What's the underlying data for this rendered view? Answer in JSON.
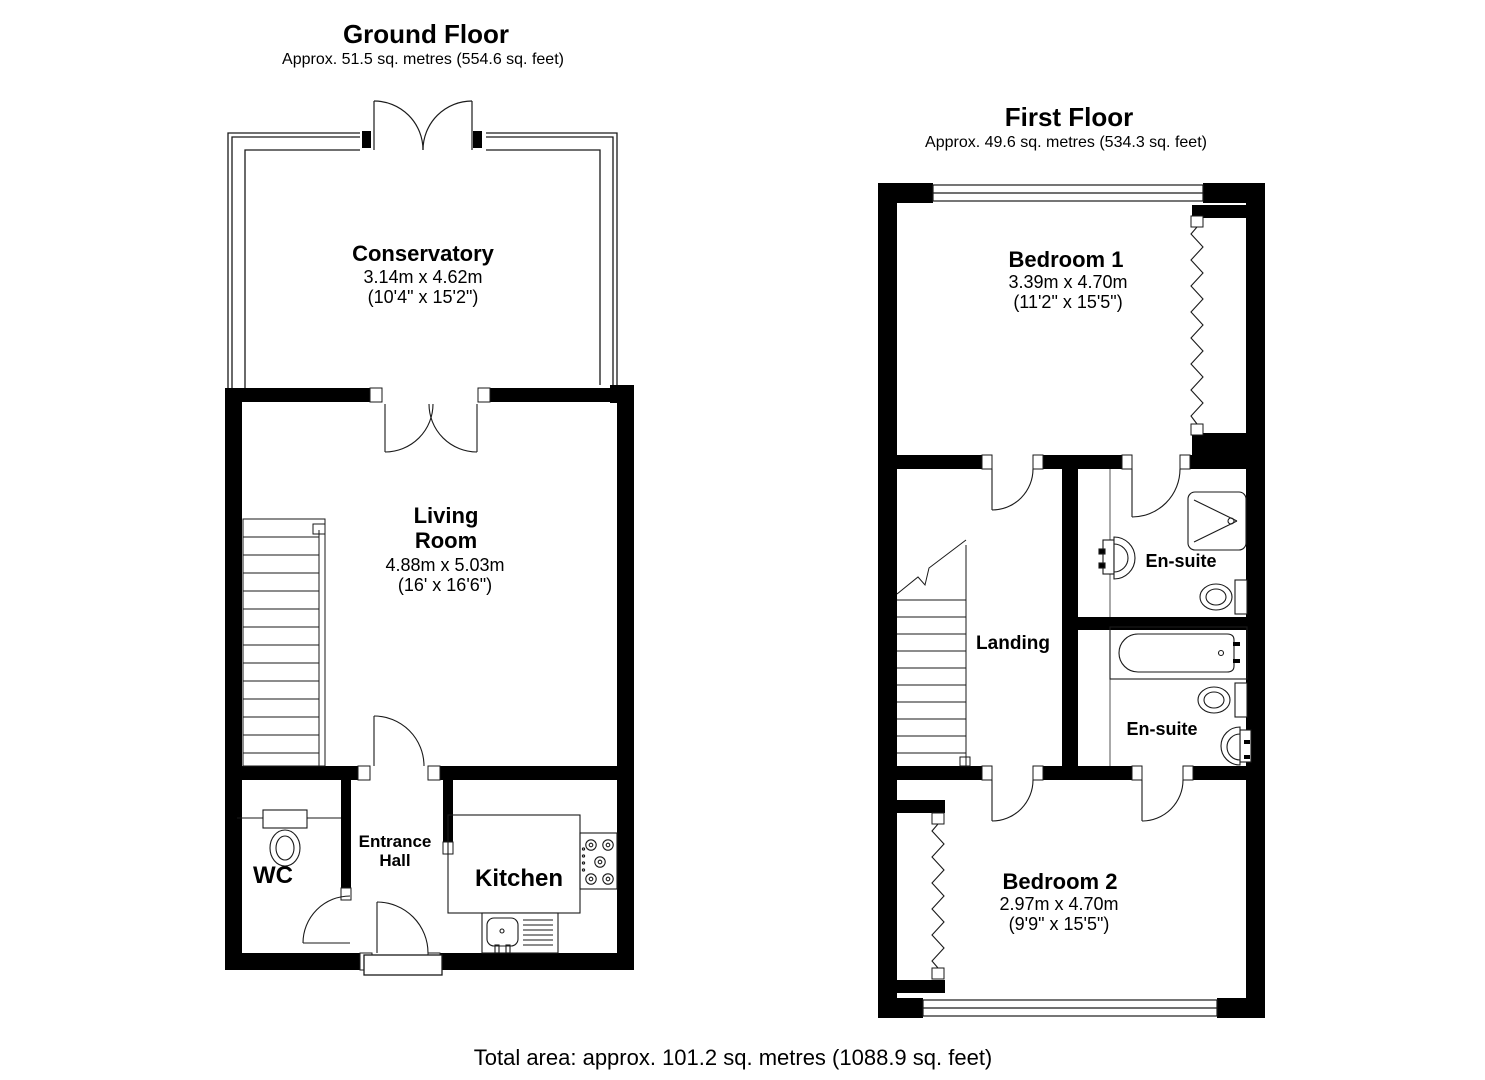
{
  "ground_floor": {
    "title": "Ground Floor",
    "subtitle": "Approx. 51.5 sq. metres (554.6 sq. feet)",
    "rooms": {
      "conservatory": {
        "name": "Conservatory",
        "dims_metric": "3.14m x 4.62m",
        "dims_imperial": "(10'4\" x 15'2\")"
      },
      "living_room": {
        "name_line1": "Living",
        "name_line2": "Room",
        "dims_metric": "4.88m x 5.03m",
        "dims_imperial": "(16' x 16'6\")"
      },
      "wc": {
        "name": "WC"
      },
      "entrance_hall": {
        "name_line1": "Entrance",
        "name_line2": "Hall"
      },
      "kitchen": {
        "name": "Kitchen"
      }
    }
  },
  "first_floor": {
    "title": "First Floor",
    "subtitle": "Approx. 49.6 sq. metres (534.3 sq. feet)",
    "rooms": {
      "bedroom1": {
        "name": "Bedroom 1",
        "dims_metric": "3.39m x 4.70m",
        "dims_imperial": "(11'2\" x 15'5\")"
      },
      "landing": {
        "name": "Landing"
      },
      "ensuite1": {
        "name": "En-suite"
      },
      "ensuite2": {
        "name": "En-suite"
      },
      "bedroom2": {
        "name": "Bedroom 2",
        "dims_metric": "2.97m x 4.70m",
        "dims_imperial": "(9'9\" x 15'5\")"
      }
    }
  },
  "footer": {
    "total_area": "Total area: approx. 101.2 sq. metres (1088.9 sq. feet)"
  },
  "colors": {
    "wall": "#000000",
    "line": "#1a1a1a",
    "background": "#ffffff",
    "text": "#000000"
  }
}
